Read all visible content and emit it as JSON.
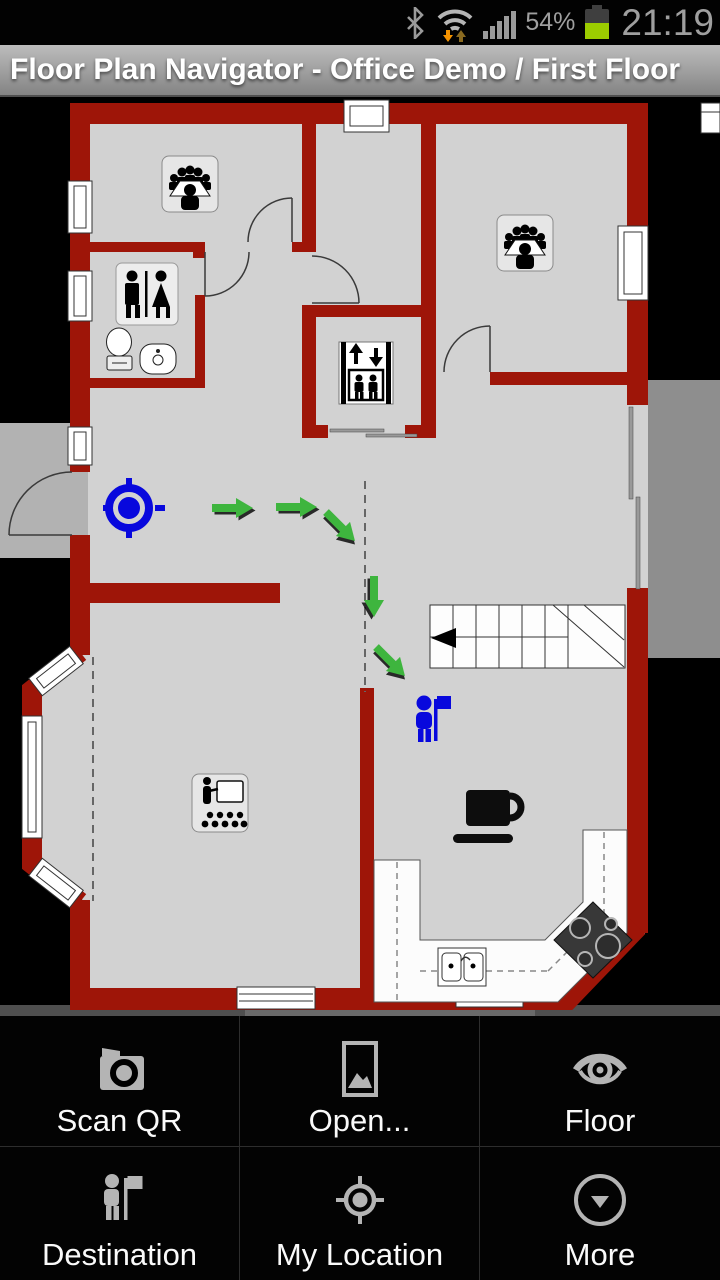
{
  "status_bar": {
    "battery_percent": "54%",
    "time": "21:19",
    "icons": [
      "bluetooth-icon",
      "wifi-data-icon",
      "signal-strength-icon",
      "battery-icon"
    ]
  },
  "title_bar": {
    "title": "Floor Plan Navigator - Office Demo / First Floor"
  },
  "floor_plan": {
    "rooms": [
      "meeting-room-northwest",
      "meeting-room-northeast",
      "restroom",
      "elevator",
      "stairs",
      "presentation-room",
      "kitchen",
      "coffee-area"
    ],
    "markers": {
      "my_location": "blue crosshair marker in entrance hall",
      "destination": "blue person-with-flag marker near stairs"
    },
    "route_arrows": [
      "right",
      "right",
      "down-right",
      "down",
      "down-right"
    ]
  },
  "menu": {
    "items": [
      {
        "label": "Scan QR",
        "icon": "camera-icon"
      },
      {
        "label": "Open...",
        "icon": "picture-icon"
      },
      {
        "label": "Floor",
        "icon": "eye-icon"
      },
      {
        "label": "Destination",
        "icon": "person-flag-icon"
      },
      {
        "label": "My Location",
        "icon": "crosshair-icon"
      },
      {
        "label": "More",
        "icon": "circle-chevron-down-icon"
      }
    ]
  },
  "theme": {
    "wall": "#9e1508",
    "floor": "#d2d2d2",
    "outside": "#000000",
    "porch": "#b2b2b2",
    "terrace": "#8e8e8e",
    "route": "#3eb53e",
    "marker": "#0808dd",
    "menu_icon": "#b4b4b4",
    "battery": "#9ccc00",
    "wifi_arrow": "#f59300",
    "statusbar_text": "#9f9f9f"
  }
}
